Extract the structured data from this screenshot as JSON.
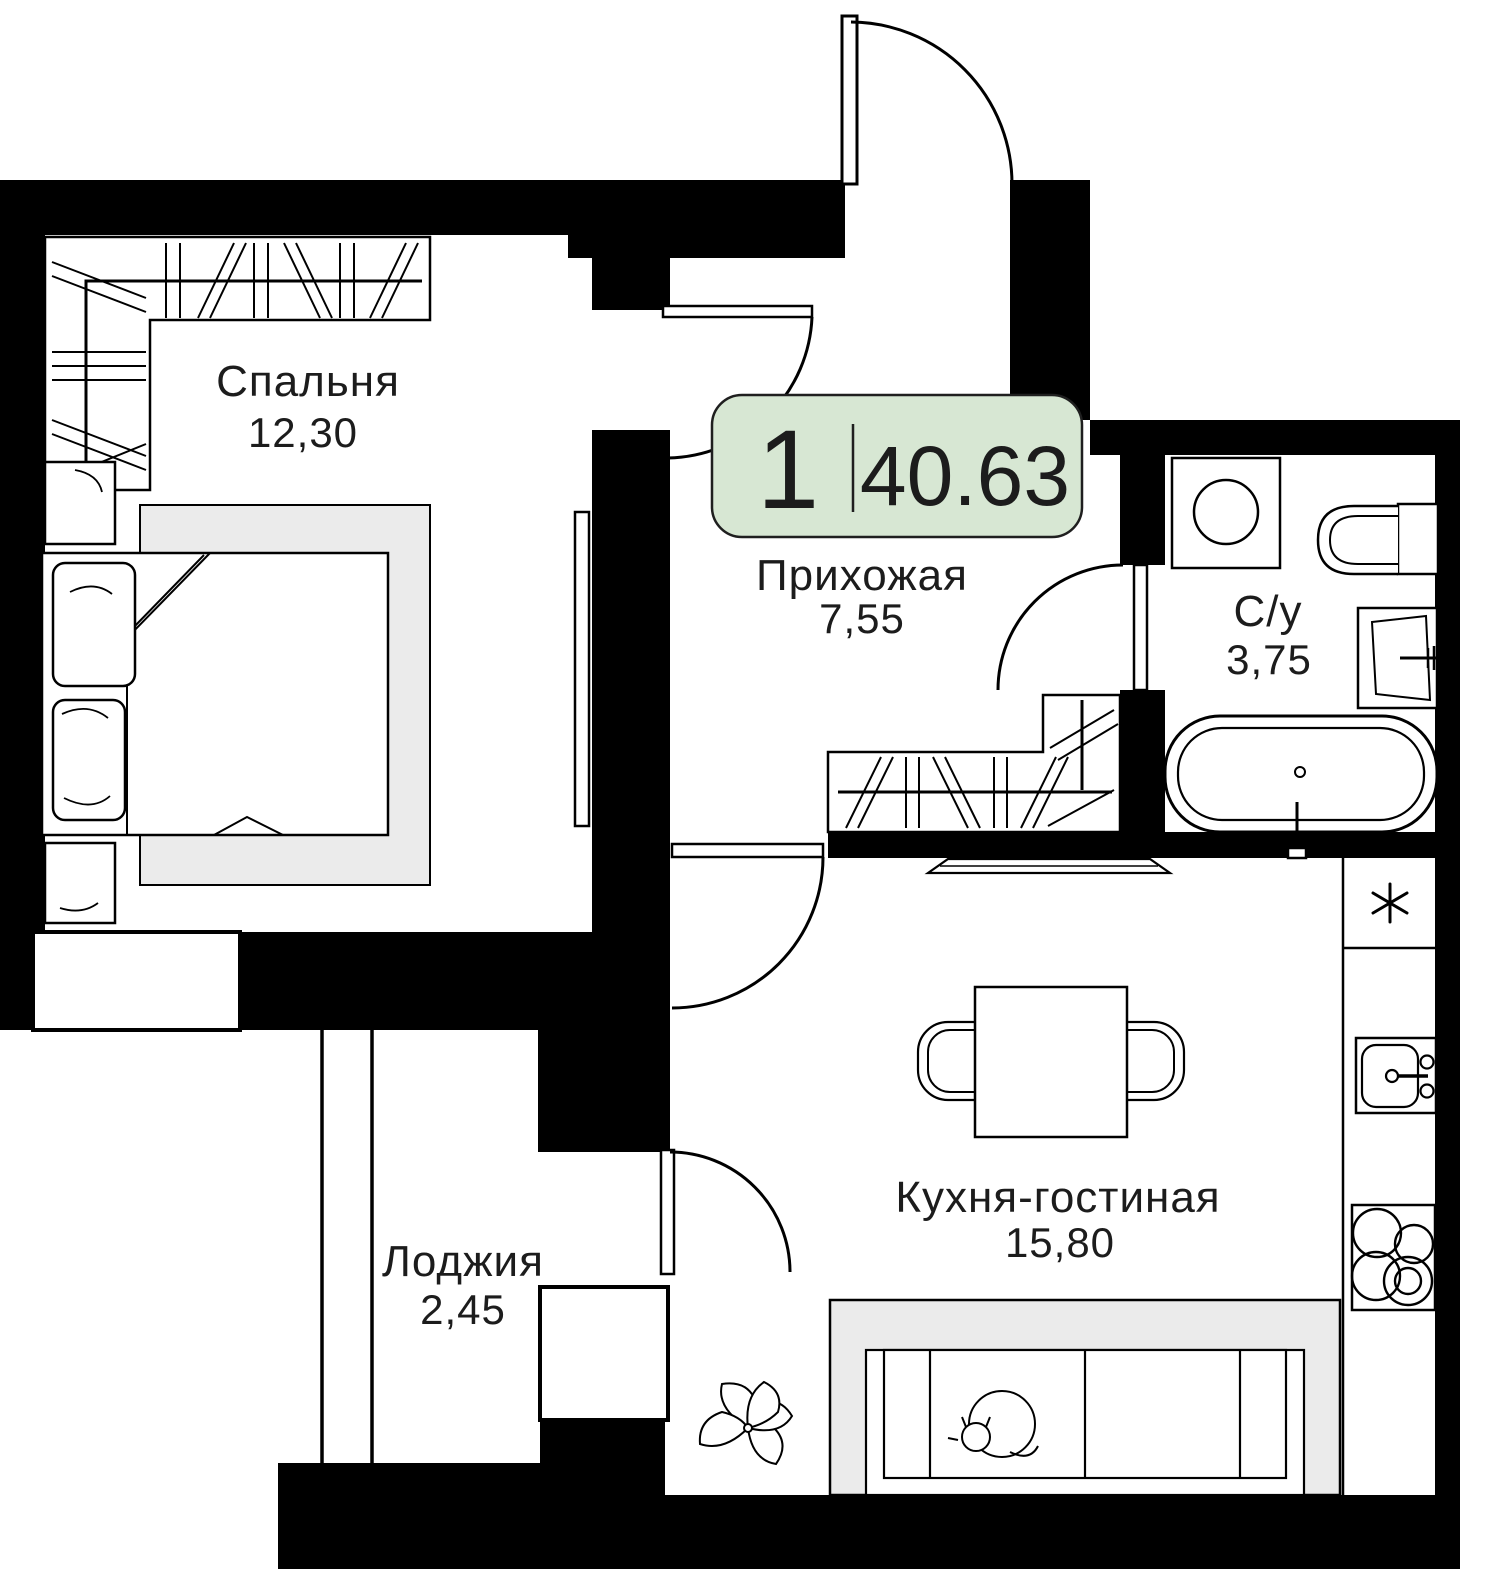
{
  "badge": {
    "room_count": "1",
    "total_area": "40.63"
  },
  "rooms": [
    {
      "name": "Спальня",
      "area": "12,30"
    },
    {
      "name": "Прихожая",
      "area": "7,55"
    },
    {
      "name": "С/у",
      "area": "3,75"
    },
    {
      "name": "Кухня-гостиная",
      "area": "15,80"
    },
    {
      "name": "Лоджия",
      "area": "2,45"
    }
  ],
  "colors": {
    "wall": "#000000",
    "line": "#000000",
    "text": "#1c1c1c",
    "badge_bg": "#d7e7d3",
    "badge_border": "#1f1f1f",
    "furniture_gray": "#ebebeb"
  },
  "fixtures": [
    "double-bed",
    "wardrobe-bedroom",
    "nightstand",
    "pillow",
    "mirror",
    "wardrobe-hallway",
    "washing-machine",
    "toilet",
    "wash-basin",
    "bathtub",
    "fridge",
    "kitchen-sink",
    "cooktop",
    "dining-table",
    "chair",
    "sofa",
    "sleeping-cat",
    "plant",
    "tv-panel",
    "window",
    "door-arc"
  ]
}
